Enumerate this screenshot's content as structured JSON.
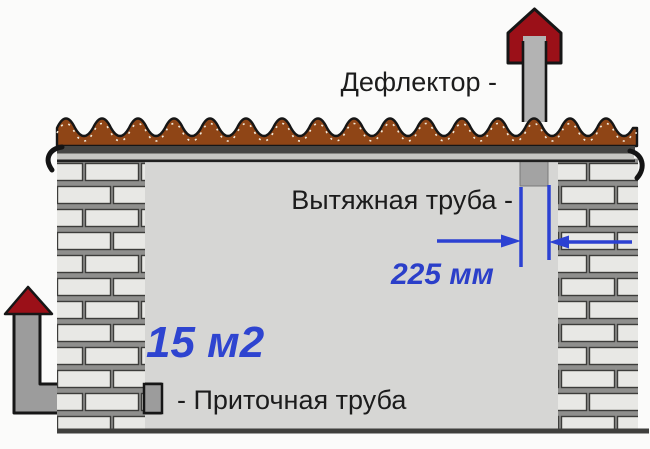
{
  "diagram": {
    "labels": {
      "deflector": "Дефлектор -",
      "exhaust_pipe": "Вытяжная труба -",
      "pipe_diameter": "225 мм",
      "room_area": "15 м2",
      "supply_pipe": "- Приточная труба"
    },
    "colors": {
      "annotation_blue": "#2c41d2",
      "deflector_red": "#9b1018",
      "roof_brown": "#8f4516",
      "roof_fascia_dark": "#454543",
      "roof_fascia_light": "#c6c6c2",
      "brick_light": "#e8e8e5",
      "mortar_gray": "#8f8f8d",
      "pipe_gray": "#9c9c9c",
      "wall_interior": "#d6d6d4",
      "outline_black": "#161616"
    }
  }
}
